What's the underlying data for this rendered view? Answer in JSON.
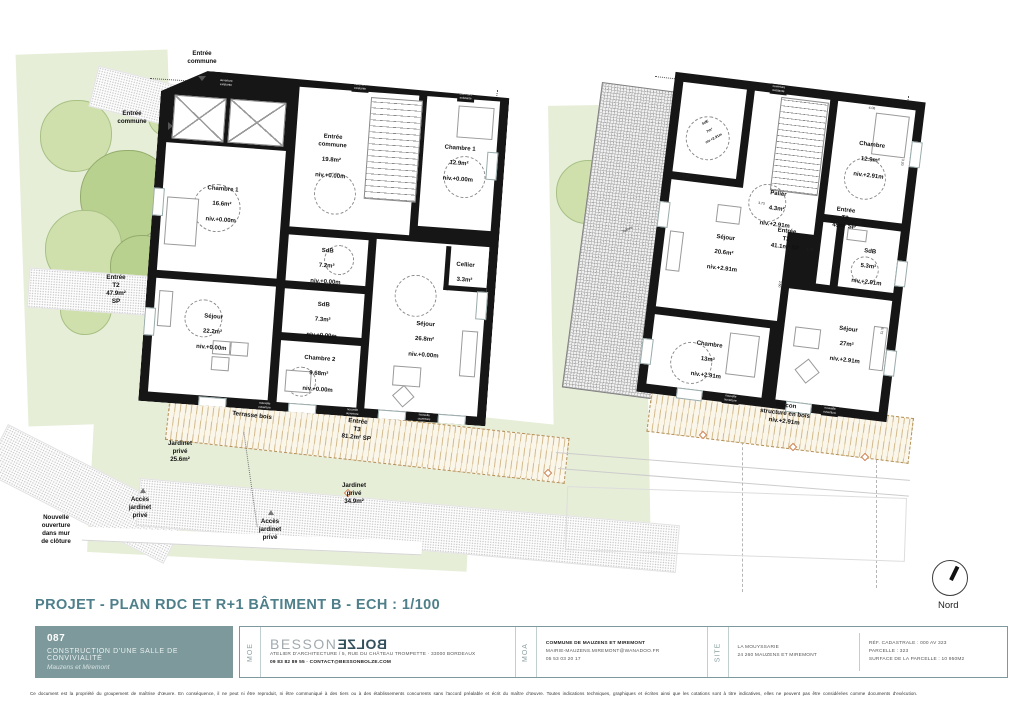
{
  "sheet": {
    "title": "PROJET - PLAN RDC ET R+1 BÂTIMENT B - ECH : 1/100",
    "north_label": "Nord",
    "disclaimer": "Ce document est la propriété du groupement de maîtrise d'œuvre. En conséquence, il ne peut ni être reproduit, ni être communiqué à des tiers ou à des établissements concurrents sans l'accord préalable et écrit du maître d'œuvre. Toutes indications techniques, graphiques et écrites ainsi que les cotations sont à titre indicatives, elles ne peuvent pas être considérées comme documents d'exécution."
  },
  "wall_tags": {
    "new": "nouvelle\nouverture",
    "existing": "ouverture\nexistante"
  },
  "plan_left": {
    "rooms": [
      {
        "name": "Chambre 1",
        "area": "16.6m²",
        "level": "niv.+0.00m"
      },
      {
        "name": "Entrée\ncommune",
        "area": "19.8m²",
        "level": "niv.+0.00m"
      },
      {
        "name": "Chambre 1",
        "area": "12.9m²",
        "level": "niv.+0.00m"
      },
      {
        "name": "SdB",
        "area": "7.2m²",
        "level": "niv.+0.00m"
      },
      {
        "name": "SdB",
        "area": "7.3m²",
        "level": "niv.+0.00m"
      },
      {
        "name": "Cellier",
        "area": "3.3m²",
        "level": ""
      },
      {
        "name": "Séjour",
        "area": "22.2m²",
        "level": "niv.+0.00m"
      },
      {
        "name": "Chambre 2",
        "area": "9.68m²",
        "level": "niv.+0.00m"
      },
      {
        "name": "Séjour",
        "area": "26.8m²",
        "level": "niv.+0.00m"
      }
    ],
    "annotations": {
      "entree_commune_top": "Entrée\ncommune",
      "entree_commune_left": "Entrée\ncommune",
      "entree_t2": "Entrée\nT2\n47.9m²\nSP",
      "entree_t3": "Entrée\nT3\n81.2m² SP",
      "terrasse": "Terrasse bois",
      "jardinet_a": "Jardinet\nprivé\n25.6m²",
      "jardinet_b": "Jardinet\nprivé\n34.9m²",
      "acces_a": "Accès\njardinet\nprivé",
      "acces_b": "Accès\njardinet\nprivé",
      "mur_ouverture": "Nouvelle\nouverture\ndans mur\nde clôture"
    }
  },
  "plan_right": {
    "rooms": [
      {
        "name": "SdE",
        "area": "7m²",
        "level": "niv.+2.91m"
      },
      {
        "name": "Palier",
        "area": "4.3m²",
        "level": "niv.+2.91m"
      },
      {
        "name": "Chambre",
        "area": "12.9m²",
        "level": "niv.+2.91m"
      },
      {
        "name": "SdB",
        "area": "5.3m²",
        "level": "niv.+2.91m"
      },
      {
        "name": "Séjour",
        "area": "20.6m²",
        "level": "niv.+2.91m"
      },
      {
        "name": "Chambre",
        "area": "13m²",
        "level": "niv.+2.91m"
      },
      {
        "name": "Séjour",
        "area": "27m²",
        "level": "niv.+2.91m"
      }
    ],
    "annotations": {
      "entree_t2_45": "Entrée\nT2\n45m² SP",
      "entree_t2_41": "Entrée\nT2\n41.1m² SP",
      "balcon": "Balcon\nstructure en bois\nniv.+2.91m",
      "toiture": "Toiture"
    },
    "dimensions": [
      "4.06",
      "4.71",
      "2.60",
      "6.72",
      "3.20",
      "2.03",
      "1.92",
      "3.73",
      "1.21"
    ]
  },
  "titleblock": {
    "project_number": "087",
    "project_title": "CONSTRUCTION D'UNE SALLE DE CONVIVIALITÉ",
    "project_subtitle": "Mauzens et Miremont",
    "moe_label": "MOE",
    "brand_first": "BESSON",
    "brand_second": "BOLZE",
    "moe_address": "ATELIER D'ARCHITECTURE / 5, RUE DU CHÂTEAU TROMPETTE · 33000 BORDEAUX",
    "moe_contact": "09 83 82 89 55 · CONTACT@BESSONBOLZE.COM",
    "moa_label": "MOA",
    "moa_name": "COMMUNE DE MAUZENS ET MIREMONT",
    "moa_email": "MAIRIE-MAUZENS.MIREMONT@WANADOO.FR",
    "moa_phone": "05 53 03 20 17",
    "site_label": "SITE",
    "site_name": "LA MOUYSSARIE",
    "site_address": "24 260 MAUZENS ET MIREMONT",
    "cadastre_ref": "RÉF. CADASTRALE : 000 AV 323",
    "cadastre_parcel": "PARCELLE : 323",
    "cadastre_surface": "SURFACE DE LA PARCELLE : 10 950M2"
  },
  "colors": {
    "accent": "#4E7F8A",
    "panel": "#7D999B",
    "wall": "#161616",
    "garden": "#E6EED8",
    "tree": "#CFE0AD",
    "wood": "#D2BA8C"
  }
}
